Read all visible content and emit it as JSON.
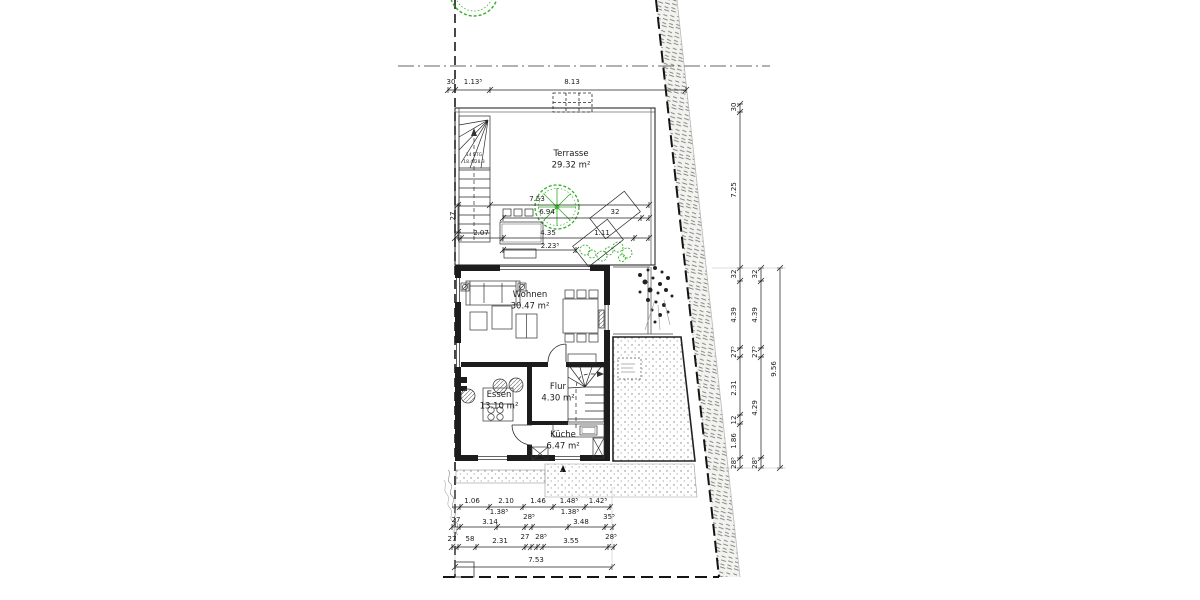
{
  "plan": {
    "rooms": [
      {
        "name": "Terrasse",
        "area": "29.32 m²",
        "x": 571,
        "y": 156
      },
      {
        "name": "Wohnen",
        "area": "30.47 m²",
        "x": 530,
        "y": 297
      },
      {
        "name": "Essen",
        "area": "13.10 m²",
        "x": 499,
        "y": 397
      },
      {
        "name": "Flur",
        "area": "4.30 m²",
        "x": 558,
        "y": 389
      },
      {
        "name": "Küche",
        "area": "6.47 m²",
        "x": 563,
        "y": 437
      }
    ],
    "stair_label": {
      "lines": [
        "14 STG",
        "18.4/28.3"
      ],
      "x": 474,
      "y": 156
    },
    "dim_labels": [
      {
        "text": "30",
        "x": 451,
        "y": 84
      },
      {
        "text": "1.13⁵",
        "x": 473,
        "y": 84
      },
      {
        "text": "8.13",
        "x": 572,
        "y": 84
      },
      {
        "text": "7.53",
        "x": 537,
        "y": 201
      },
      {
        "text": "6.94",
        "x": 547,
        "y": 214
      },
      {
        "text": "32",
        "x": 615,
        "y": 214
      },
      {
        "text": "2.07",
        "x": 481,
        "y": 235
      },
      {
        "text": "4.35",
        "x": 548,
        "y": 235
      },
      {
        "text": "1.11",
        "x": 602,
        "y": 235
      },
      {
        "text": "2.23⁵",
        "x": 550,
        "y": 248
      },
      {
        "text": "27",
        "x": 455,
        "y": 216,
        "rot": -90
      },
      {
        "text": "30",
        "x": 736,
        "y": 107,
        "rot": -90
      },
      {
        "text": "7.25",
        "x": 736,
        "y": 190,
        "rot": -90
      },
      {
        "text": "32",
        "x": 736,
        "y": 274,
        "rot": -90
      },
      {
        "text": "4.39",
        "x": 736,
        "y": 315,
        "rot": -90
      },
      {
        "text": "27⁵",
        "x": 736,
        "y": 352,
        "rot": -90
      },
      {
        "text": "2.31",
        "x": 736,
        "y": 388,
        "rot": -90
      },
      {
        "text": "12",
        "x": 736,
        "y": 420,
        "rot": -90
      },
      {
        "text": "1.86",
        "x": 736,
        "y": 441,
        "rot": -90
      },
      {
        "text": "28⁵",
        "x": 736,
        "y": 463,
        "rot": -90
      },
      {
        "text": "32",
        "x": 757,
        "y": 274,
        "rot": -90
      },
      {
        "text": "4.39",
        "x": 757,
        "y": 315,
        "rot": -90
      },
      {
        "text": "27⁵",
        "x": 757,
        "y": 352,
        "rot": -90
      },
      {
        "text": "4.29",
        "x": 757,
        "y": 408,
        "rot": -90
      },
      {
        "text": "28⁵",
        "x": 757,
        "y": 463,
        "rot": -90
      },
      {
        "text": "9.56",
        "x": 776,
        "y": 369,
        "rot": -90
      },
      {
        "text": "1.06",
        "x": 472,
        "y": 503
      },
      {
        "text": "2.10",
        "x": 506,
        "y": 503
      },
      {
        "text": "1.46",
        "x": 538,
        "y": 503
      },
      {
        "text": "1.48⁵",
        "x": 569,
        "y": 503
      },
      {
        "text": "1.42⁵",
        "x": 598,
        "y": 503
      },
      {
        "text": "1.38⁵",
        "x": 499,
        "y": 514
      },
      {
        "text": "1.38⁵",
        "x": 570,
        "y": 514
      },
      {
        "text": "27",
        "x": 456,
        "y": 522
      },
      {
        "text": "3.14",
        "x": 490,
        "y": 524
      },
      {
        "text": "28⁵",
        "x": 529,
        "y": 519
      },
      {
        "text": "3.48",
        "x": 581,
        "y": 524
      },
      {
        "text": "35⁵",
        "x": 609,
        "y": 519
      },
      {
        "text": "27",
        "x": 452,
        "y": 541
      },
      {
        "text": "58",
        "x": 470,
        "y": 541
      },
      {
        "text": "2.31",
        "x": 500,
        "y": 543
      },
      {
        "text": "27",
        "x": 525,
        "y": 539
      },
      {
        "text": "28⁵",
        "x": 541,
        "y": 539
      },
      {
        "text": "3.55",
        "x": 571,
        "y": 543
      },
      {
        "text": "28⁵",
        "x": 611,
        "y": 539
      },
      {
        "text": "7.53",
        "x": 536,
        "y": 562
      }
    ],
    "colors": {
      "line": "#1a1a1a",
      "wall": "#1c1c1c",
      "green": "#2fae23",
      "stipple": "#888888"
    }
  }
}
